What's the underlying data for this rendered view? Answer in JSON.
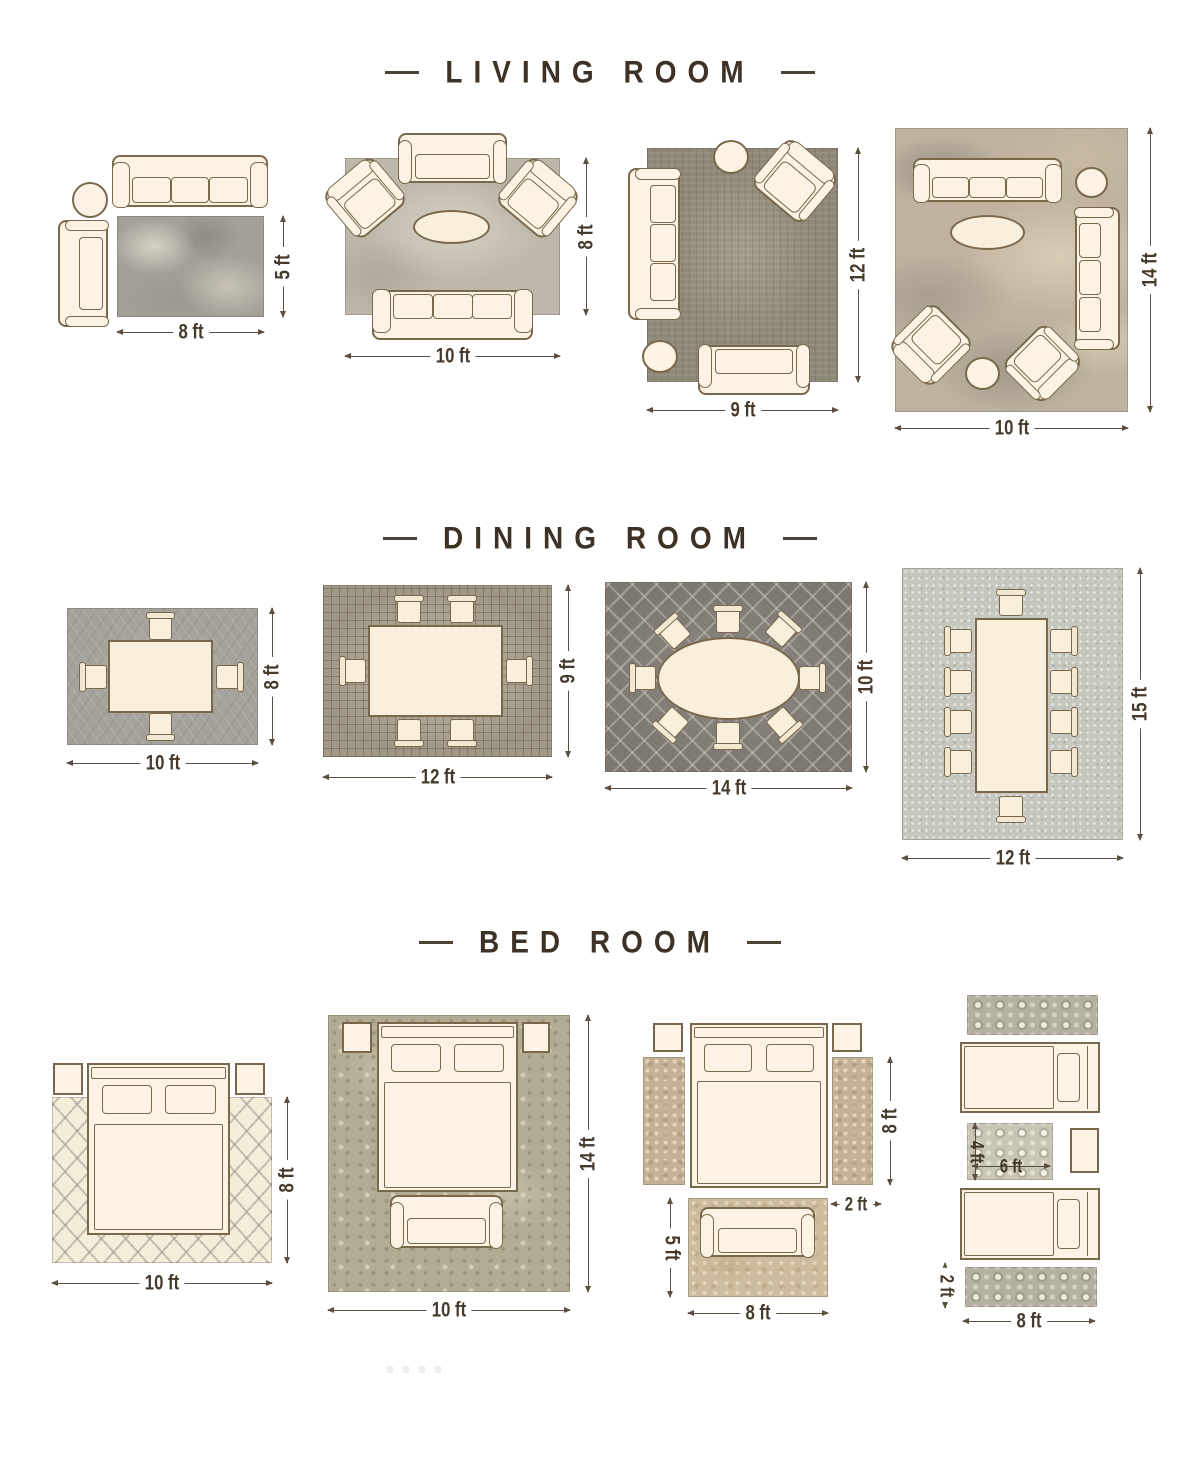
{
  "page": {
    "background": "#ffffff"
  },
  "colors": {
    "ink": "#3e3227",
    "furniture_outline": "#7a684c",
    "furniture_fill": "#fcf3e5",
    "dimension": "#5b4f41"
  },
  "sections": [
    {
      "id": "living-room",
      "title": "LIVING ROOM",
      "layouts": [
        {
          "id": "living-rug-8x5",
          "rug_width": "8 ft",
          "rug_height": "5 ft"
        },
        {
          "id": "living-rug-10x8",
          "rug_width": "10 ft",
          "rug_height": "8 ft"
        },
        {
          "id": "living-rug-9x12",
          "rug_width": "9 ft",
          "rug_height": "12 ft"
        },
        {
          "id": "living-rug-10x14",
          "rug_width": "10 ft",
          "rug_height": "14 ft"
        }
      ]
    },
    {
      "id": "dining-room",
      "title": "DINING ROOM",
      "layouts": [
        {
          "id": "dining-rug-10x8",
          "rug_width": "10 ft",
          "rug_height": "8 ft"
        },
        {
          "id": "dining-rug-12x9",
          "rug_width": "12 ft",
          "rug_height": "9 ft"
        },
        {
          "id": "dining-rug-14x10",
          "rug_width": "14 ft",
          "rug_height": "10 ft"
        },
        {
          "id": "dining-rug-12x15",
          "rug_width": "12 ft",
          "rug_height": "15 ft"
        }
      ]
    },
    {
      "id": "bed-room",
      "title": "BED ROOM",
      "layouts": [
        {
          "id": "bedroom-rug-10x8",
          "rug_width": "10 ft",
          "rug_height": "8 ft"
        },
        {
          "id": "bedroom-rug-10x14",
          "rug_width": "10 ft",
          "rug_height": "14 ft"
        },
        {
          "id": "bedroom-runners-5x8",
          "side_height": "8 ft",
          "runner_width": "2 ft",
          "rug_height": "5 ft",
          "rug_width": "8 ft"
        },
        {
          "id": "bedroom-twin-runners",
          "mid_rug_height": "4 ft",
          "mid_rug_width": "6 ft",
          "runner_height": "2 ft",
          "runner_width": "8 ft"
        }
      ]
    }
  ]
}
